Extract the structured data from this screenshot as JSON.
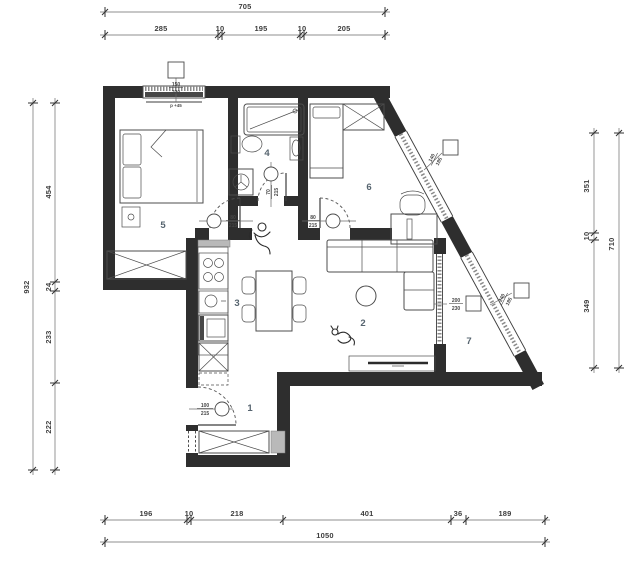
{
  "dims": {
    "top": {
      "overall": "705",
      "segments": [
        "285",
        "10",
        "195",
        "10",
        "205"
      ]
    },
    "bottom": {
      "overall": "1050",
      "segments": [
        "196",
        "10",
        "218",
        "401",
        "36",
        "189"
      ]
    },
    "left": {
      "overall": "932",
      "segments": [
        "454",
        "24",
        "233",
        "222"
      ]
    },
    "right": {
      "overall": "710",
      "segments": [
        "351",
        "10",
        "349"
      ]
    }
  },
  "rooms": {
    "r1": "1",
    "r2": "2",
    "r3": "3",
    "r4": "4",
    "r5": "5",
    "r6": "6",
    "r7": "7"
  },
  "doors": {
    "bedroom": {
      "w": "80",
      "h": "215"
    },
    "room6": {
      "w": "80",
      "h": "215"
    },
    "bathroom": {
      "w": "70",
      "h": "215"
    },
    "entry": {
      "w": "100",
      "h": "215"
    }
  },
  "windows": {
    "bedroom": {
      "w": "150",
      "h": "220",
      "parapet": "p +45"
    },
    "room6": {
      "w": "140",
      "h": "185"
    },
    "living": {
      "w": "200",
      "h": "230"
    },
    "balcony": {
      "w": "240",
      "h": "185"
    }
  },
  "colors": {
    "wall": "#2e2e2e",
    "dimension": "#3d3d3d",
    "room_number": "#56646f",
    "background": "#ffffff"
  }
}
